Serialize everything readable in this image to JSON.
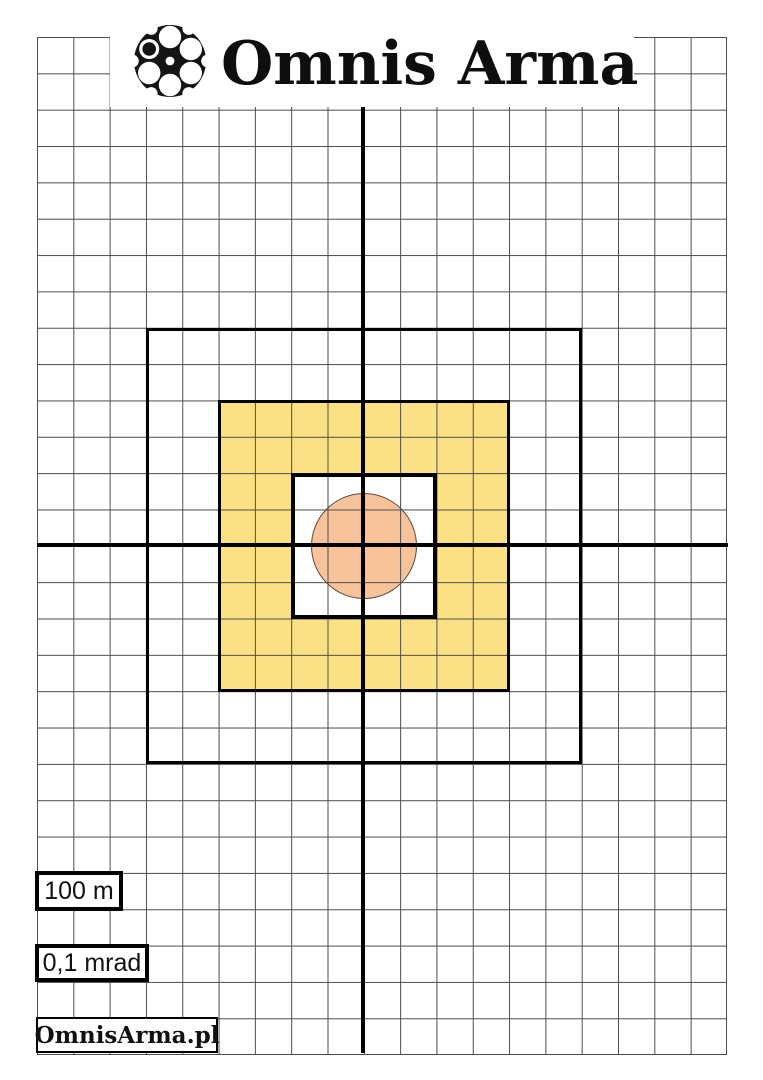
{
  "header": {
    "brand": "Omnis Arma",
    "logo_icon": "revolver-cylinder-icon"
  },
  "labels": {
    "distance": "100 m",
    "angular_unit": "0,1 mrad",
    "website": "OmnisArma.pl"
  },
  "grid": {
    "columns": 19,
    "rows": 28
  },
  "target": {
    "outer_square_cells": 12,
    "yellow_square_cells": 8,
    "inner_square_cells": 4,
    "circle_diameter_cells": 3
  },
  "colors": {
    "yellow_fill": "#FBE183",
    "circle_fill": "#F8C39B",
    "grid_line": "#4D4D4D",
    "line_black": "#000000"
  }
}
